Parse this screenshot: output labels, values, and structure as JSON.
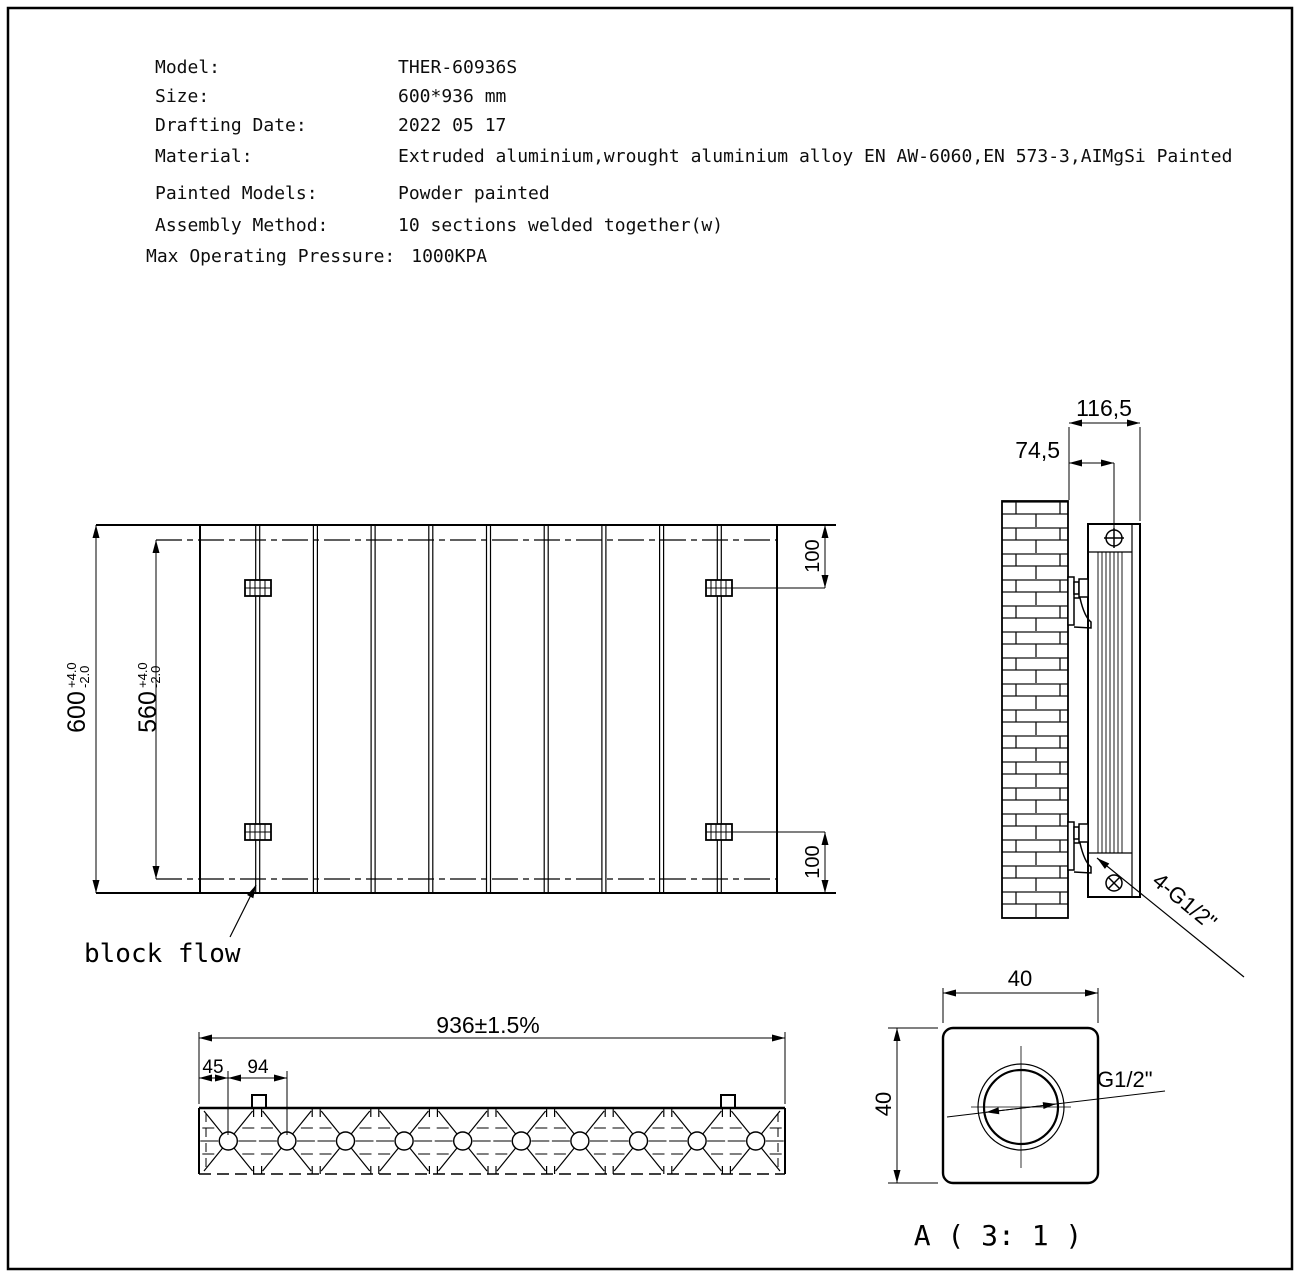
{
  "spec": {
    "rows": [
      {
        "label": "Model:",
        "value": "THER-60936S"
      },
      {
        "label": "Size:",
        "value": "600*936 mm"
      },
      {
        "label": "Drafting Date:",
        "value": "2022 05 17"
      },
      {
        "label": "Material:",
        "value": "Extruded aluminium,wrought aluminium alloy EN AW-6060,EN 573-3,AIMgSi Painted"
      },
      {
        "label": "Painted Models:",
        "value": "Powder painted"
      },
      {
        "label": "Assembly Method:",
        "value": "10 sections welded together(w)"
      },
      {
        "label": "Max Operating Pressure:",
        "value": "1000KPA"
      }
    ]
  },
  "front_view": {
    "height": "600",
    "height_tol_plus": "+4.0",
    "height_tol_minus": "-2.0",
    "inner_height": "560",
    "inner_tol_plus": "+4.0",
    "inner_tol_minus": "-2.0",
    "bracket_offset_top": "100",
    "bracket_offset_bottom": "100",
    "flow_label": "block flow"
  },
  "side_view": {
    "depth": "116,5",
    "port_offset": "74,5",
    "ports_label": "4-G1/2\""
  },
  "bottom_view": {
    "width": "936±1.5%",
    "port_inset": "45",
    "port_pitch": "94"
  },
  "detail_view": {
    "width": "40",
    "height": "40",
    "thread_label": "G1/2\"",
    "caption": "A ( 3: 1 )"
  },
  "colors": {
    "line": "#000000",
    "background": "#ffffff"
  }
}
